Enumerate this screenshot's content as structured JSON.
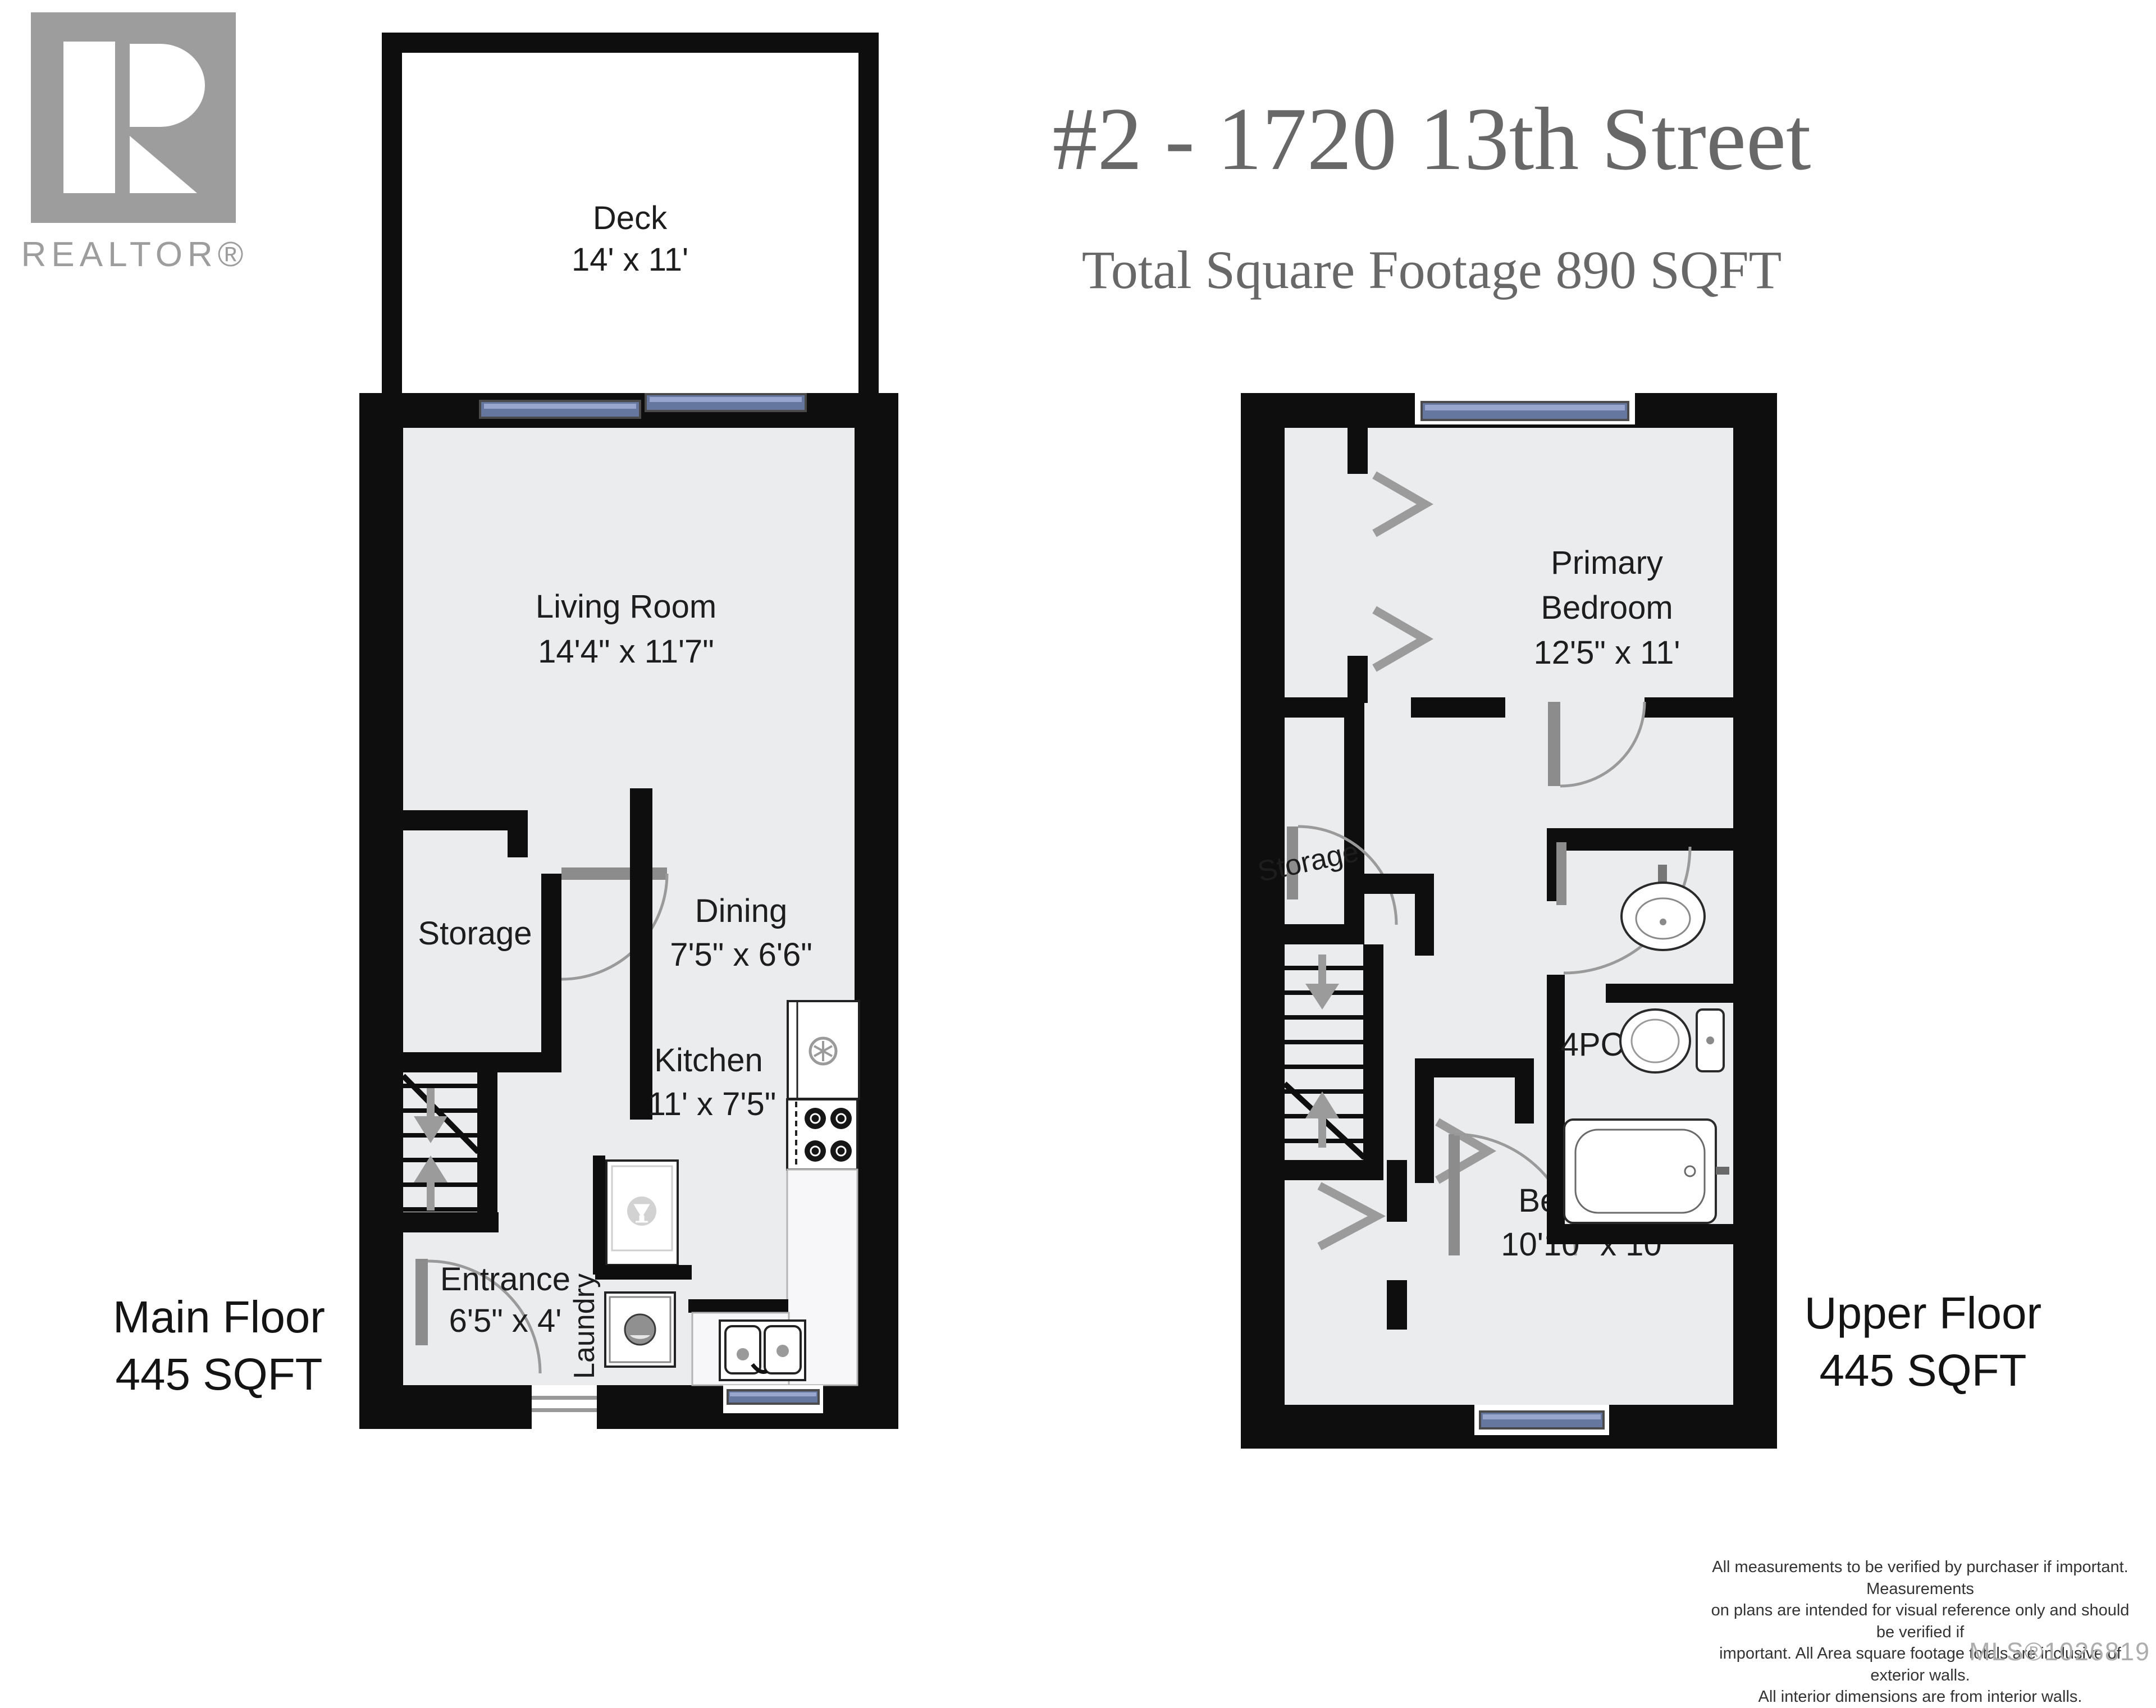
{
  "logo": {
    "brand": "REALTOR®"
  },
  "header": {
    "address": "#2 - 1720 13th Street",
    "subtitle": "Total Square Footage 890 SQFT"
  },
  "main_floor": {
    "label": {
      "line1": "Main Floor",
      "line2": "445 SQFT"
    },
    "rooms": {
      "deck": {
        "name": "Deck",
        "dims": "14' x 11'"
      },
      "living_room": {
        "name": "Living Room",
        "dims": "14'4\" x 11'7\""
      },
      "storage": {
        "name": "Storage"
      },
      "dining": {
        "name": "Dining",
        "dims": "7'5\" x 6'6\""
      },
      "kitchen": {
        "name": "Kitchen",
        "dims": "11' x 7'5\""
      },
      "entrance": {
        "name": "Entrance",
        "dims": "6'5\" x 4'"
      },
      "laundry": {
        "name": "Laundry"
      }
    }
  },
  "upper_floor": {
    "label": {
      "line1": "Upper Floor",
      "line2": "445 SQFT"
    },
    "rooms": {
      "primary_bedroom": {
        "name_line1": "Primary",
        "name_line2": "Bedroom",
        "dims": "12'5\" x 11'"
      },
      "storage": {
        "name": "Storage"
      },
      "bathroom": {
        "name": "4PC"
      },
      "bedroom": {
        "name": "Bedroom",
        "dims": "10'10\" x 10'"
      }
    }
  },
  "footer": {
    "disclaimer": [
      "All measurements to be verified by purchaser if important. Measurements",
      "on plans are intended for visual reference only and should be verified if",
      "important. All Area square footage totals are inclusive of exterior walls.",
      "All interior dimensions are from interior walls."
    ],
    "mls": "MLS®1026819"
  },
  "colors": {
    "wall": "#0e0e0e",
    "floor": "#ebecee",
    "window_blue": "#66779f",
    "door_gray": "#8c8c8c",
    "logo_gray": "#9d9d9d",
    "title_gray": "#686868"
  }
}
